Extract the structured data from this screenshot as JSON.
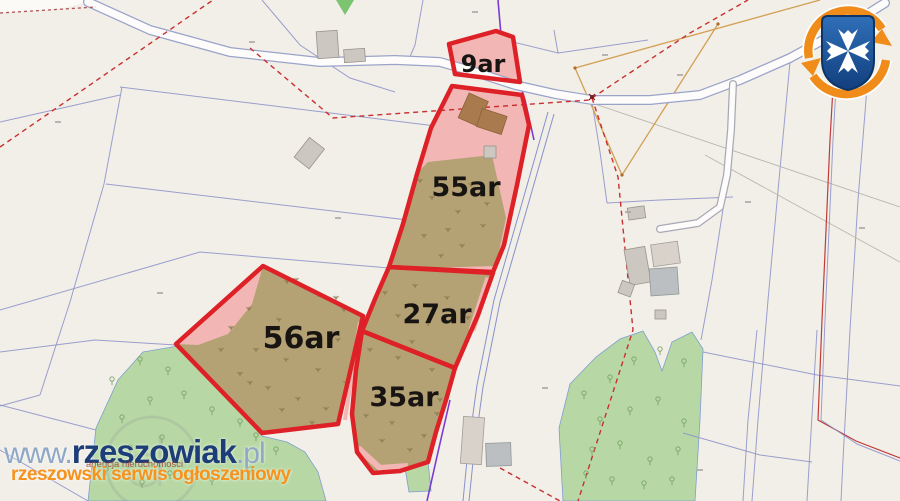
{
  "map": {
    "parcels": [
      {
        "label": "9ar"
      },
      {
        "label": "55ar"
      },
      {
        "label": "27ar"
      },
      {
        "label": "35ar"
      },
      {
        "label": "56ar"
      }
    ]
  },
  "watermark": {
    "site_www": "www.",
    "site_name": "rzeszowiak",
    "site_tld": ".pl",
    "agency_line": "agencja nieruchomości",
    "tagline": "rzeszowski serwis ogłoszeniowy"
  },
  "icons": {
    "brand_logo": "rzeszow-city-crest-with-orange-refresh-arrows",
    "tree_symbol": "deciduous-tree-map-symbol",
    "scrub_symbol": "scrub-vegetation-map-symbol"
  },
  "theme": {
    "map_background": "#f2efe8",
    "parcel_line": "#8a8fc8",
    "road_fill": "#fdfcfb",
    "road_casing": "#9aa3c9",
    "forest_green": "#b7d8a4",
    "highlight_border": "#dd2127",
    "highlight_fill_pink": "#f2b7b5",
    "highlight_fill_scrub": "#b4a275",
    "label_color": "#171411",
    "watermark_navy": "#1c3d78",
    "watermark_lightblue": "#90a8c8",
    "watermark_orange": "#f6921e",
    "watermark_red": "#9c4a3a"
  }
}
